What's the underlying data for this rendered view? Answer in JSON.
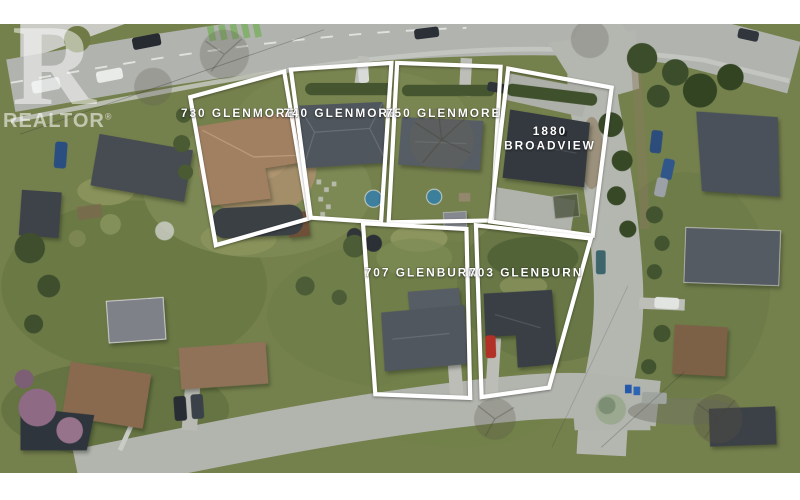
{
  "watermark": {
    "logo_letter": "R",
    "brand_text": "REALTOR",
    "registered_mark": "®"
  },
  "overlay": {
    "outline_color": "#ffffff",
    "label_color": "#ffffff",
    "parcels": [
      {
        "id": "730-glenmore",
        "label": "730 GLENMORE",
        "label_lines": [
          "730 GLENMORE"
        ],
        "points": "179,101 278,74 304,229 206,257",
        "label_x": 230,
        "label_y": 122
      },
      {
        "id": "740-glenmore",
        "label": "740 GLENMORE",
        "label_lines": [
          "740 GLENMORE"
        ],
        "points": "285,72 391,65 380,233 306,228",
        "label_x": 338,
        "label_y": 122
      },
      {
        "id": "750-glenmore",
        "label": "750 GLENMORE",
        "label_lines": [
          "750 GLENMORE"
        ],
        "points": "397,65 506,69 497,231 388,233",
        "label_x": 446,
        "label_y": 122
      },
      {
        "id": "1880-broadview",
        "label": "1880 BROADVIEW",
        "label_lines": [
          "1880",
          "BROADVIEW"
        ],
        "points": "514,71 623,91 603,247 495,232",
        "label_x": 558,
        "label_y": 141
      },
      {
        "id": "707-glenburn",
        "label": "707 GLENBURN",
        "label_lines": [
          "707 GLENBURN"
        ],
        "points": "361,234 470,240 474,418 374,414",
        "label_x": 423,
        "label_y": 290
      },
      {
        "id": "703-glenburn",
        "label": "703 GLENBURN",
        "label_lines": [
          "703 GLENBURN"
        ],
        "points": "480,236 601,250 557,407 486,417",
        "label_x": 533,
        "label_y": 290
      }
    ]
  },
  "scene": {
    "letterbox_color": "#ffffff"
  }
}
